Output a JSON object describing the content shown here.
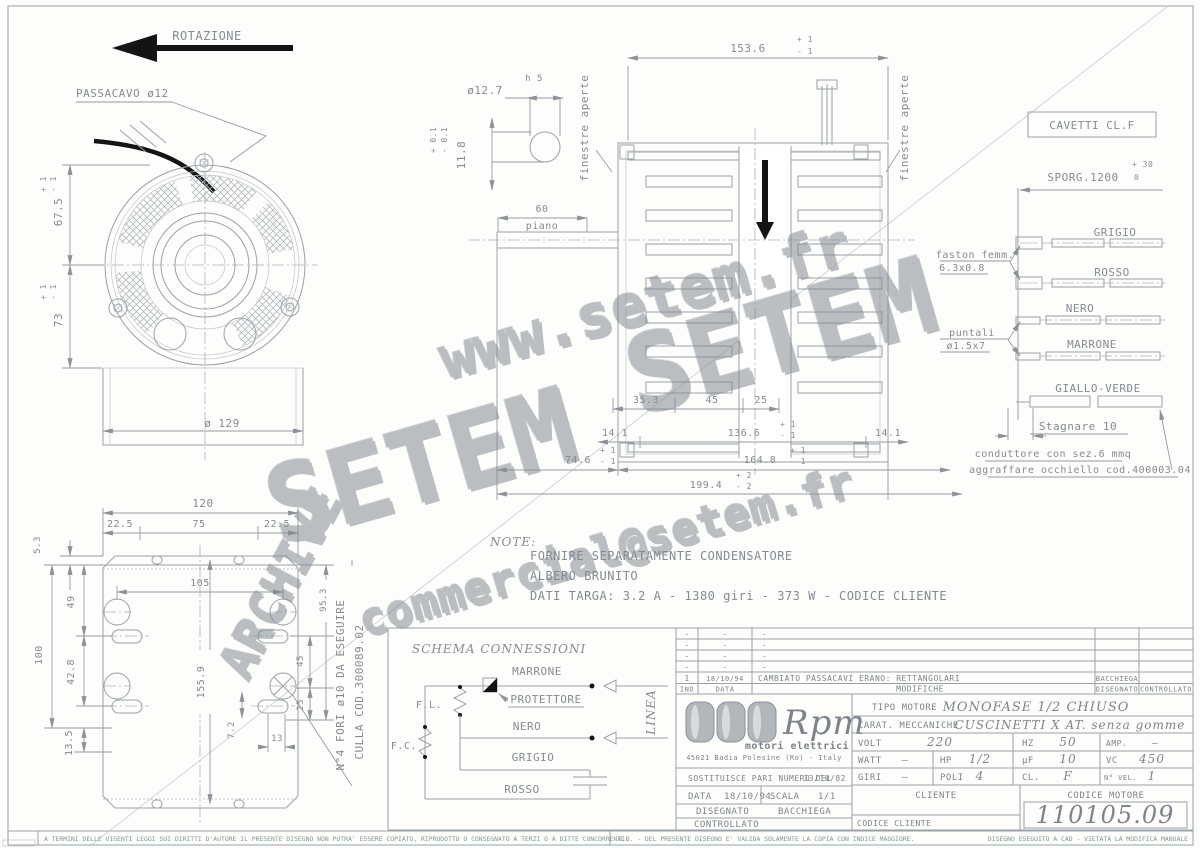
{
  "top": {
    "rotazione": "ROTAZIONE",
    "passacavo": "PASSACAVO ø12"
  },
  "front": {
    "d1": "67.5",
    "d2": "73",
    "dia": "ø 129",
    "tp": "+ 1",
    "tm": "- 1"
  },
  "key": {
    "dia": "ø12.7",
    "h": "h 5",
    "len": "11.8",
    "tp": "+ 0.1",
    "tm": "- 0.1"
  },
  "side": {
    "len": "153.6",
    "tp1": "+ 1",
    "tm1": "- 1",
    "fin": "finestre aperte",
    "p60": "60",
    "piano": "piano",
    "a": "35.3",
    "b": "45",
    "c": "25",
    "e1": "14.1",
    "e2": "136.6",
    "e3": "14.1",
    "f": "74.6",
    "g": "164.8",
    "h": "199.4",
    "tp2": "+ 2",
    "tm2": "- 2"
  },
  "cav": {
    "box": "CAVETTI CL.F",
    "sporg": "SPORG.1200",
    "tp": "+ 30",
    "tm": "0",
    "f1": "faston femm.",
    "f2": "6.3x0.8",
    "p1": "puntali",
    "p2": "ø1.5x7",
    "w1": "GRIGIO",
    "w2": "ROSSO",
    "w3": "NERO",
    "w4": "MARRONE",
    "w5": "GIALLO-VERDE",
    "stag": "Stagnare 10",
    "c1": "conduttore con sez.6 mmq",
    "c2": "aggraffare occhiello cod.400003.04"
  },
  "plate": {
    "w": "120",
    "s1": "22.5",
    "s2": "75",
    "s3": "22.5",
    "a": "5.3",
    "b": "49",
    "c": "100",
    "d": "42.8",
    "e": "13.5",
    "f": "105",
    "g": "155.9",
    "h": "95.3",
    "i": "45",
    "j": "25",
    "k": "7.2",
    "l": "13",
    "n1": "N°4 FORI ø10 DA ESEGUIRE",
    "n2": "CULLA COD.300089.02"
  },
  "notes": {
    "t": "NOTE:",
    "l1": "FORNIRE SEPARATAMENTE CONDENSATORE",
    "l2": "ALBERO BRUNITO",
    "l3": "DATI TARGA: 3.2 A - 1380 giri - 373 W - CODICE CLIENTE"
  },
  "schema": {
    "title": "SCHEMA CONNESSIONI",
    "marrone": "MARRONE",
    "prot": "PROTETTORE",
    "nero": "NERO",
    "grigio": "GRIGIO",
    "rosso": "ROSSO",
    "fl": "F.L.",
    "fc": "F.C.",
    "linea": "LINEA"
  },
  "wm": {
    "w1": "www.setem.fr",
    "w2": "SETEM",
    "w3": "commercial@setem.fr",
    "w4": "ARCHIVE"
  },
  "tb": {
    "dash": "-",
    "r1_ind": "1",
    "r1_data": "18/10/94",
    "r1_mod": "CAMBIATO PASSACAVI ERANO: RETTANGOLARI",
    "r1_dis": "BACCHIEGA",
    "h_ind": "IND",
    "h_data": "DATA",
    "h_mod": "MODIFICHE",
    "h_dis": "DISEGNATO",
    "h_con": "CONTROLLATO",
    "logo": "Rpm",
    "logo_sub": "motori elettrici",
    "addr": "45021 Badia Polesine (Ro) - Italy",
    "sost": "SOSTITUISCE PARI NUMERO DEL",
    "sost_d": "13/10/82",
    "data_l": "DATA",
    "data_v": "18/10/94",
    "scala_l": "SCALA",
    "scala_v": "1/1",
    "dis_l": "DISEGNATO",
    "dis_v": "BACCHIEGA",
    "con_l": "CONTROLLATO",
    "tipo_l": "TIPO MOTORE",
    "tipo_v": "MONOFASE 1/2 CHIUSO",
    "car_l": "CARAT. MECCANICHE",
    "car_v": "CUSCINETTI X AT. senza gomme",
    "volt_l": "VOLT",
    "volt_v": "220",
    "hz_l": "HZ",
    "hz_v": "50",
    "amp_l": "AMP.",
    "amp_v": "–",
    "watt_l": "WATT",
    "watt_v": "–",
    "hp_l": "HP",
    "hp_v": "1/2",
    "uf_l": "µF",
    "uf_v": "10",
    "vc_l": "VC",
    "vc_v": "450",
    "giri_l": "GIRI",
    "giri_v": "–",
    "poli_l": "POLI",
    "poli_v": "4",
    "cl_l": "CL.",
    "cl_v": "F",
    "nvel_l": "N° VEL.",
    "nvel_v": "1",
    "cliente": "CLIENTE",
    "cod_mot": "CODICE MOTORE",
    "cod_cli": "CODICE CLIENTE",
    "code": "110105.09"
  },
  "legal": {
    "l": "A TERMINI DELLE VIGENTI LEGGI SUI DIRITTI D'AUTORE IL PRESENTE DISEGNO NON POTRA' ESSERE COPIATO, RIPRODOTTO O CONSEGNATO A TERZI O A DITTE CONCORRENTI.",
    "r1": "N.B. - DEL PRESENTE DISEGNO E' VALIDA SOLAMENTE LA COPIA CON INDICE MAGGIORE.",
    "r2": "DISEGNO ESEGUITO A CAD - VIETATA LA MODIFICA MANUALE"
  }
}
